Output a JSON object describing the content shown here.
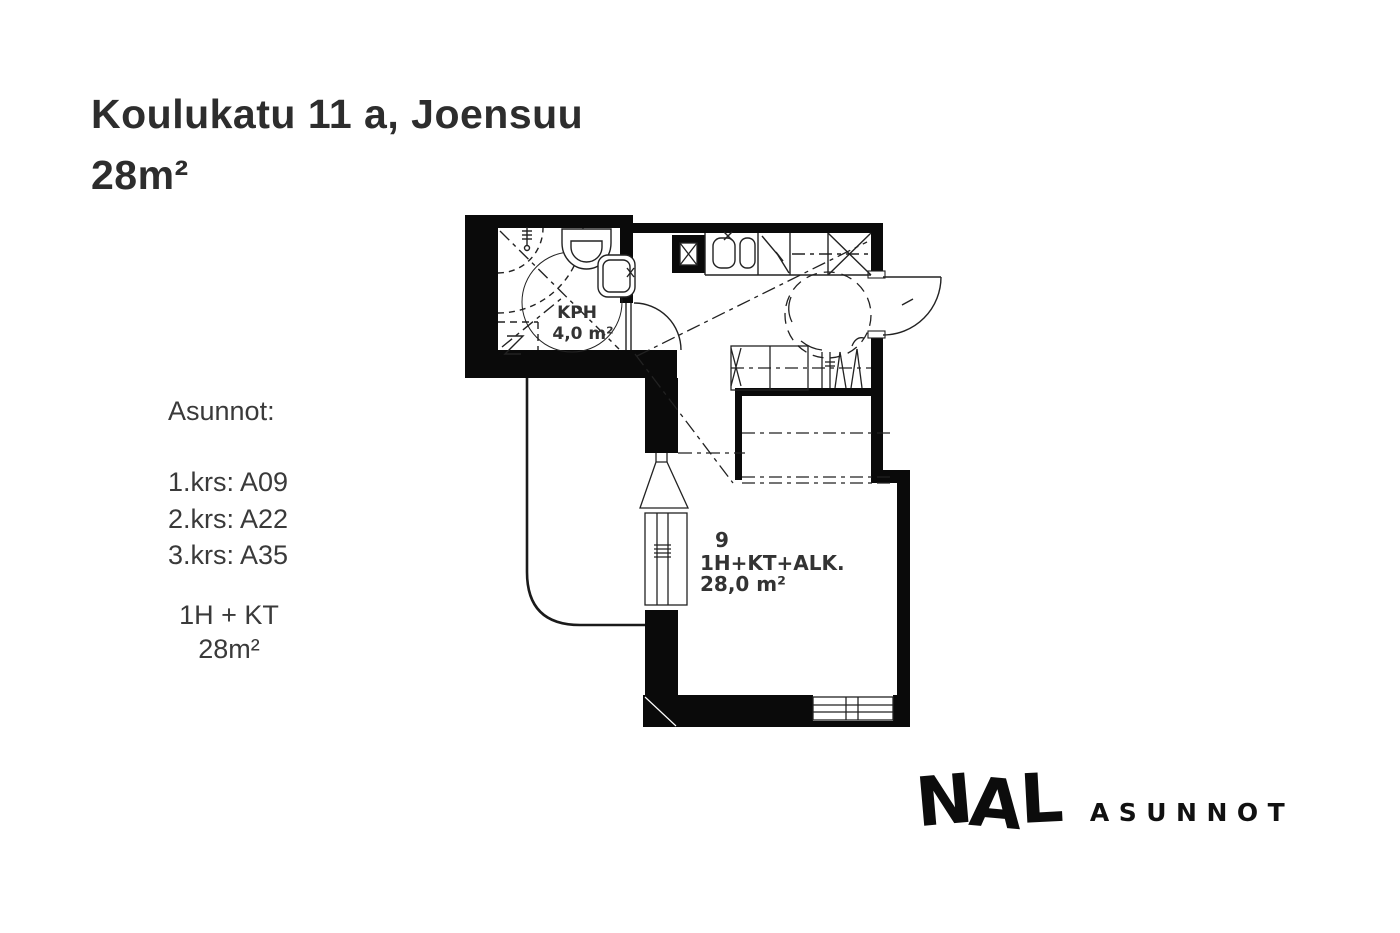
{
  "title": {
    "line1": "Koulukatu 11 a, Joensuu",
    "line2": "28m²"
  },
  "apartments": {
    "heading": "Asunnot:",
    "floors": [
      "1.krs: A09",
      "2.krs: A22",
      "3.krs: A35"
    ],
    "type": "1H + KT",
    "size": "28m²"
  },
  "floorplan": {
    "bathroom": {
      "name": "KPH",
      "area": "4,0 m²"
    },
    "main_room": {
      "number": "9",
      "type": "1H+KT+ALK.",
      "area": "28,0 m²"
    }
  },
  "logo": {
    "letters": [
      "N",
      "A",
      "L"
    ],
    "suffix": "ASUNNOT"
  },
  "colors": {
    "background": "#ffffff",
    "wall_ink": "#0a0a0a",
    "line_ink": "#222222",
    "title_text": "#2d2d2d",
    "body_text": "#3a3a3a",
    "plan_text": "#333333"
  }
}
